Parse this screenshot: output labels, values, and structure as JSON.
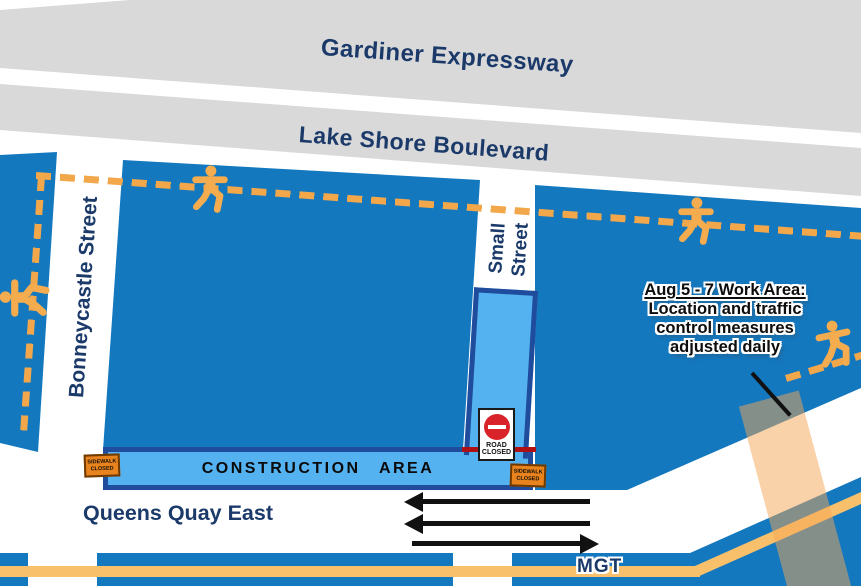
{
  "roads": {
    "gardiner": "Gardiner Expressway",
    "lake_shore": "Lake Shore Boulevard",
    "bonneycastle": "Bonneycastle Street",
    "small_line1": "Small",
    "small_line2": "Street",
    "queens_quay": "Queens Quay East",
    "mgt": "MGT"
  },
  "zones": {
    "construction_area": "CONSTRUCTION AREA"
  },
  "signs": {
    "road_closed": {
      "line1": "ROAD",
      "line2": "CLOSED"
    },
    "sidewalk_closed": {
      "line1": "SIDEWALK",
      "line2": "CLOSED"
    }
  },
  "callout": {
    "line1": "Aug 5 - 7 Work Area:",
    "line2": "Location and traffic",
    "line3": "control measures",
    "line4": "adjusted daily"
  },
  "icons": {
    "pedestrian": "walking-person-icon",
    "no_entry": "no-entry-icon"
  },
  "colors": {
    "road_block_blue": "#1478BF",
    "construction_fill": "#55B2F1",
    "construction_border": "#1F4C9C",
    "highway_gray": "#D9D9D9",
    "label_navy": "#1B3A69",
    "detour_orange": "#F2A74B",
    "trail_orange": "#F9C06B",
    "work_area_orange": "#F6A656",
    "sidewalk_sign_orange": "#E8831D",
    "no_entry_red": "#D8232A",
    "closure_line_red": "#AF1014"
  }
}
